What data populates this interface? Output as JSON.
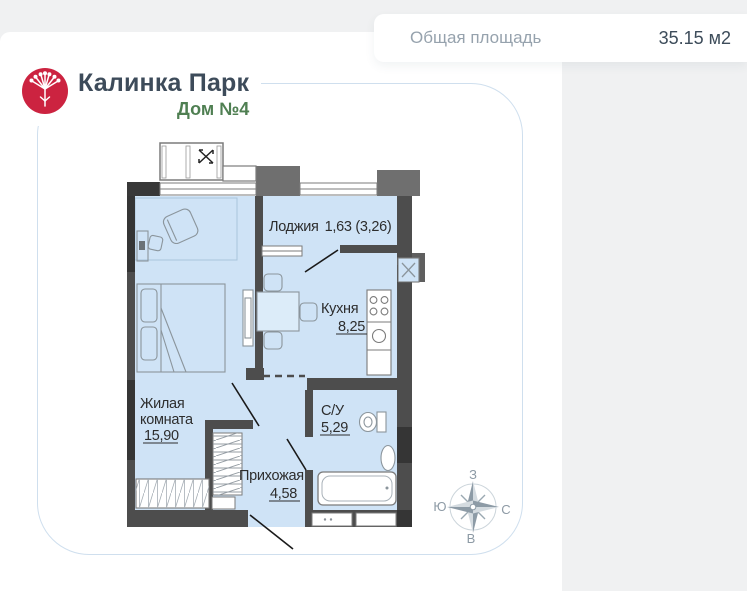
{
  "header": {
    "area_label": "Общая площадь",
    "area_value": "35.15 м2"
  },
  "brand": {
    "name": "Калинка Парк",
    "building": "Дом №4"
  },
  "colors": {
    "logo_red": "#cc2340",
    "brand_text": "#3d4b5a",
    "building_green": "#4f7f52",
    "room_fill": "#cfe3f6",
    "wall_gray": "#4d4d4d",
    "card_border_blue": "#cfdfee"
  },
  "plan": {
    "rooms": {
      "loggia": {
        "name": "Лоджия",
        "area": "1,63 (3,26)"
      },
      "kitchen": {
        "name": "Кухня",
        "area": "8,25"
      },
      "living": {
        "name_line1": "Жилая",
        "name_line2": "комната",
        "area": "15,90"
      },
      "bathroom": {
        "name": "С/У",
        "area": "5,29"
      },
      "hallway": {
        "name": "Прихожая",
        "area": "4,58"
      }
    }
  },
  "compass": {
    "top": "З",
    "left": "Ю",
    "right": "С",
    "bottom": "В"
  }
}
